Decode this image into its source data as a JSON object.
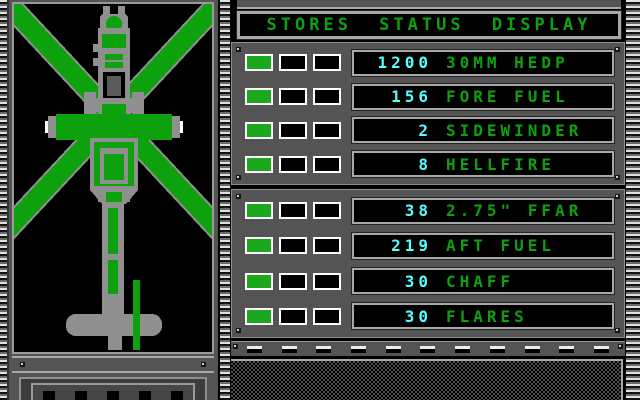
{
  "title": "STORES STATUS DISPLAY",
  "colors": {
    "panel": "#545454",
    "panel-light": "#a8a8a8",
    "green": "#0da10d",
    "cyan": "#55ffff",
    "indicator-on": "#1ca81c"
  },
  "aircraft": {
    "view": "helicopter top view",
    "rotor_color": "green",
    "body_color": "gray"
  },
  "stores": {
    "groups": [
      {
        "rows": [
          {
            "qty": "1200",
            "label": "30MM HEDP",
            "indicators": [
              "on",
              "off",
              "off"
            ]
          },
          {
            "qty": "156",
            "label": "FORE FUEL",
            "indicators": [
              "on",
              "off",
              "off"
            ]
          },
          {
            "qty": "2",
            "label": "SIDEWINDER",
            "indicators": [
              "on",
              "off",
              "off"
            ]
          },
          {
            "qty": "8",
            "label": "HELLFIRE",
            "indicators": [
              "on",
              "off",
              "off"
            ]
          }
        ]
      },
      {
        "rows": [
          {
            "qty": "38",
            "label": "2.75\" FFAR",
            "indicators": [
              "on",
              "off",
              "off"
            ]
          },
          {
            "qty": "219",
            "label": "AFT FUEL",
            "indicators": [
              "on",
              "off",
              "off"
            ]
          },
          {
            "qty": "30",
            "label": "CHAFF",
            "indicators": [
              "on",
              "off",
              "off"
            ]
          },
          {
            "qty": "30",
            "label": "FLARES",
            "indicators": [
              "on",
              "off",
              "off"
            ]
          }
        ]
      }
    ]
  }
}
